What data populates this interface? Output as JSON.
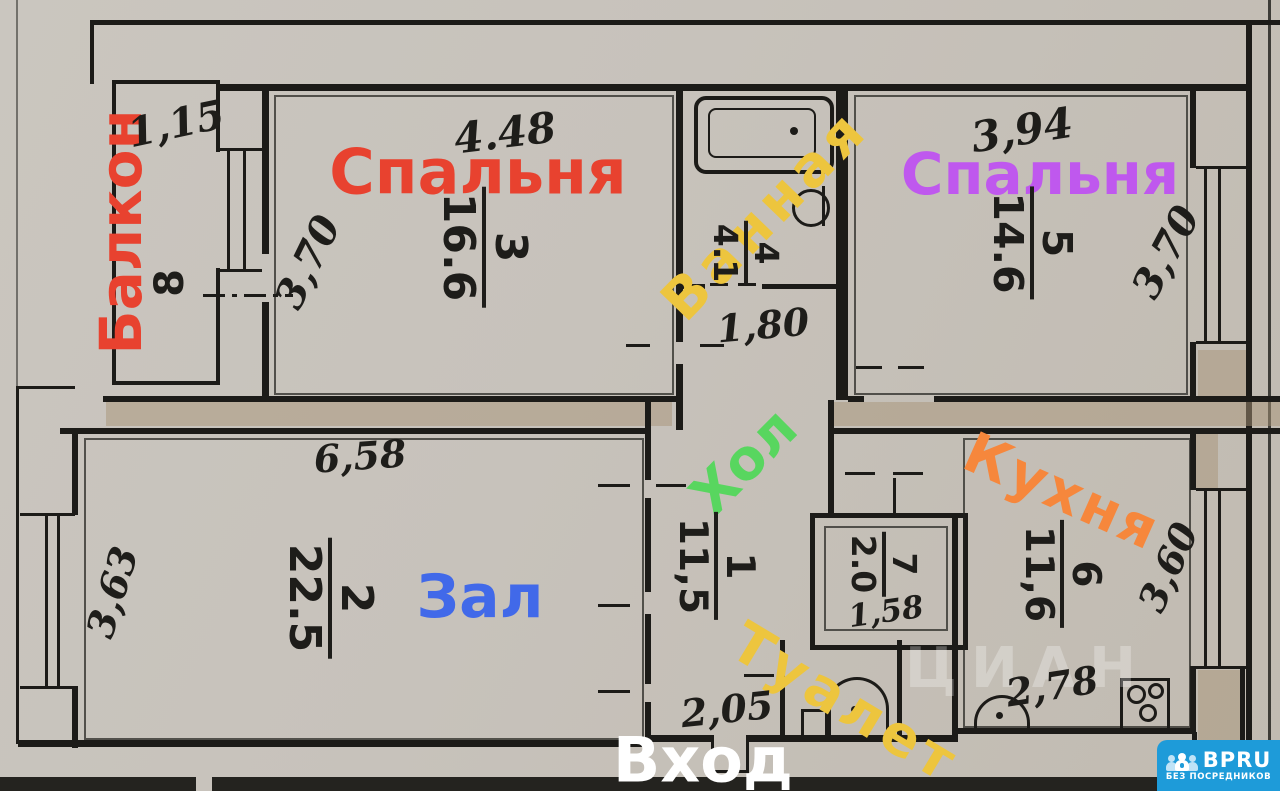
{
  "rooms": {
    "balcony": {
      "label": "Балкон",
      "number": "8",
      "width": "1,15",
      "color": "#e8422f"
    },
    "bedroom_3": {
      "label": "Спальня",
      "number": "3",
      "area": "16.6",
      "width": "4.48",
      "depth": "3,70",
      "color": "#e8422f"
    },
    "bathroom": {
      "label": "Ванная",
      "number": "4",
      "area": "4.1",
      "passage_width": "1,80",
      "color": "#edc53e"
    },
    "bedroom_5": {
      "label": "Спальня",
      "number": "5",
      "area": "14.6",
      "width": "3,94",
      "depth": "3,70",
      "color": "#bf58ee"
    },
    "living_room": {
      "label": "Зал",
      "number": "2",
      "area": "22.5",
      "width": "6,58",
      "depth": "3,63",
      "color": "#4169e9"
    },
    "hall": {
      "label": "Хол",
      "number": "1",
      "area": "11,5",
      "entry_width": "2,05",
      "color": "#58d65f"
    },
    "toilet": {
      "label": "Туалет",
      "number": "7",
      "area": "2.0",
      "width": "1,58",
      "color": "#edc53e"
    },
    "kitchen": {
      "label": "Кухня",
      "number": "6",
      "area": "11,6",
      "width": "2,78",
      "depth": "3,60",
      "color": "#f6873c"
    }
  },
  "entrance": {
    "label": "Вход",
    "color": "#ffffff"
  },
  "watermark": {
    "text": "ЦИАН"
  },
  "logo": {
    "brand": "BPRU",
    "tagline": "БЕЗ ПОСРЕДНИКОВ",
    "bg_color": "#1e9bd9"
  }
}
